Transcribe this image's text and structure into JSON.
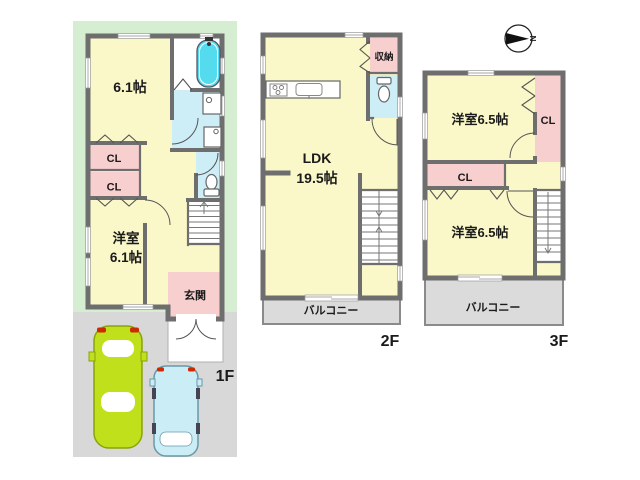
{
  "palette": {
    "room_yellow": "#FAF8C8",
    "closet_pink": "#F8CFCF",
    "water_area_blue": "#CDEEF7",
    "bathtub_cyan": "#55DBEE",
    "lot_green": "#D5EDD0",
    "paving_gray": "#D8D8D8",
    "balcony_gray": "#DBDBDB",
    "wall_gray": "#6E6E6E",
    "car_lime": "#BFE01A",
    "car_pale_blue": "#CBEDF6",
    "text_dark": "#1A1A1A"
  },
  "labels": {
    "closet": "CL",
    "balcony": "バルコニー",
    "north": "N"
  },
  "floors": {
    "f1": {
      "name": "1F",
      "bedroom_top_size": "6.1帖",
      "bedroom_bottom_name": "洋室",
      "bedroom_bottom_size": "6.1帖",
      "entrance": "玄関"
    },
    "f2": {
      "name": "2F",
      "ldk_name": "LDK",
      "ldk_size": "19.5帖",
      "storage": "収納"
    },
    "f3": {
      "name": "3F",
      "bedroom_top": "洋室6.5帖",
      "bedroom_bottom": "洋室6.5帖"
    }
  }
}
